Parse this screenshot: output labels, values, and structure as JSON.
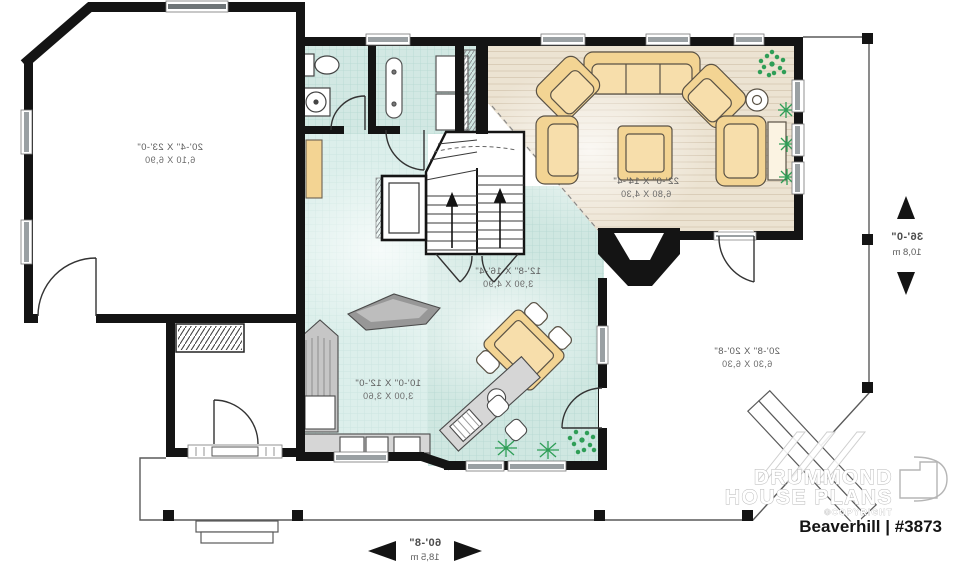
{
  "floorplan": {
    "rooms": {
      "garage": {
        "imperial": "20'-4\" X 23'-0\"",
        "metric": "6,10 X 6,90"
      },
      "living_room": {
        "imperial": "22'-0\" X 14'-4\"",
        "metric": "6,80 X 4,30"
      },
      "dining_room": {
        "imperial": "12'-8\" X 16'-4\"",
        "metric": "3,90 X 4,90"
      },
      "kitchen": {
        "imperial": "10'-0\" X 12'-0\"",
        "metric": "3,00 X 3,60"
      },
      "covered_terrace": {
        "imperial": "20'-8\" X 20'-8\"",
        "metric": "6,30 X 6,30"
      }
    },
    "overall_dimensions": {
      "depth": {
        "imperial": "36'-0\"",
        "metric": "10,8 m"
      },
      "width": {
        "imperial": "60'-8\"",
        "metric": "18,5 m"
      }
    },
    "branding": {
      "company_line1": "DRUMMOND",
      "company_line2": "HOUSE PLANS",
      "copyright": "©COPYRIGHT",
      "plan_title": "Beaverhill | #3873"
    },
    "colors": {
      "wall": "#141414",
      "tile_floor": "#d2e8e3",
      "wood_floor": "#ece3d2",
      "furniture": "#f3d493",
      "plant": "#2f9e57",
      "counter": "#d6d6d6"
    }
  }
}
